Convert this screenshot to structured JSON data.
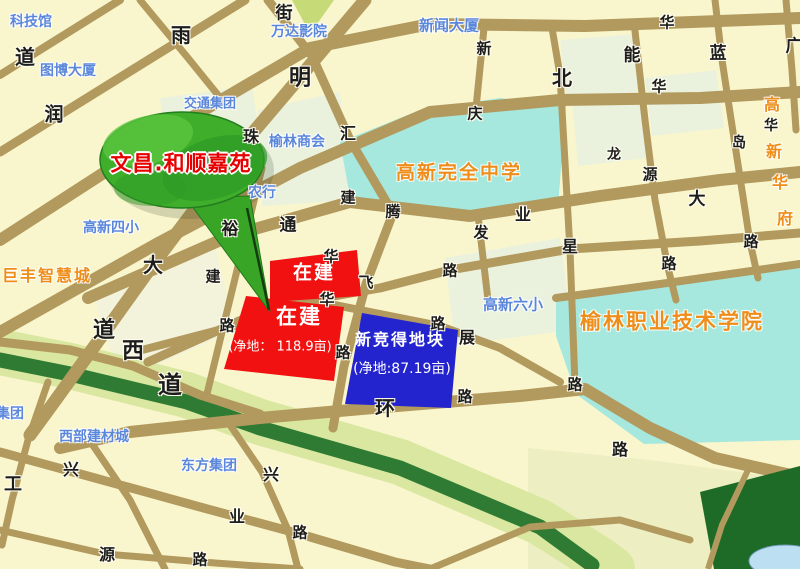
{
  "map": {
    "callout": {
      "label": "文昌.和顺嘉苑"
    },
    "plots": {
      "north_red": {
        "label": "在建"
      },
      "south_red": {
        "label": "在建",
        "area": "(净地： 118.9亩)"
      },
      "new_blue": {
        "label": "新竞得地块",
        "area": "(净地:87.19亩)"
      }
    },
    "colors": {
      "background": "#f9f6cd",
      "road": "#b2995e",
      "water_grounds": "#a6e8de",
      "pond": "#bcdff1",
      "greenbelt_dark": "#2f7b33",
      "greenbelt_light": "#d9e7a0",
      "park_dark": "#1d6b27",
      "parcel_mint": "#eaf2de",
      "plot_red": "#f21111",
      "plot_blue": "#2424cf",
      "callout_green": "#3fae2a",
      "callout_text_red": "#e60000",
      "poi_blue": "#5b87db",
      "poi_orange": "#ee8d1a"
    },
    "labels": [
      {
        "t": "道",
        "x": 25,
        "y": 57,
        "c": "road",
        "s": 20
      },
      {
        "t": "雨",
        "x": 181,
        "y": 35,
        "c": "road",
        "s": 20
      },
      {
        "t": "街",
        "x": 284,
        "y": 14,
        "c": "road",
        "s": 17
      },
      {
        "t": "明",
        "x": 300,
        "y": 79,
        "c": "road",
        "s": 22
      },
      {
        "t": "润",
        "x": 54,
        "y": 115,
        "c": "road",
        "s": 19
      },
      {
        "t": "珠",
        "x": 251,
        "y": 137,
        "c": "road",
        "s": 16
      },
      {
        "t": "汇",
        "x": 348,
        "y": 134,
        "c": "road",
        "s": 16
      },
      {
        "t": "新",
        "x": 484,
        "y": 49,
        "c": "road",
        "s": 15
      },
      {
        "t": "庆",
        "x": 475,
        "y": 114,
        "c": "road",
        "s": 15
      },
      {
        "t": "北",
        "x": 562,
        "y": 78,
        "c": "road",
        "s": 20
      },
      {
        "t": "华",
        "x": 667,
        "y": 23,
        "c": "road",
        "s": 15
      },
      {
        "t": "能",
        "x": 632,
        "y": 56,
        "c": "road",
        "s": 17
      },
      {
        "t": "蓝",
        "x": 718,
        "y": 54,
        "c": "road",
        "s": 17
      },
      {
        "t": "广",
        "x": 794,
        "y": 47,
        "c": "road",
        "s": 17
      },
      {
        "t": "华",
        "x": 659,
        "y": 87,
        "c": "road",
        "s": 15
      },
      {
        "t": "华",
        "x": 771,
        "y": 126,
        "c": "road",
        "s": 14
      },
      {
        "t": "岛",
        "x": 739,
        "y": 143,
        "c": "road",
        "s": 14
      },
      {
        "t": "龙",
        "x": 614,
        "y": 155,
        "c": "road",
        "s": 14
      },
      {
        "t": "源",
        "x": 650,
        "y": 175,
        "c": "road",
        "s": 15
      },
      {
        "t": "大",
        "x": 697,
        "y": 200,
        "c": "road",
        "s": 17
      },
      {
        "t": "路",
        "x": 751,
        "y": 242,
        "c": "road",
        "s": 15
      },
      {
        "t": "路",
        "x": 669,
        "y": 264,
        "c": "road",
        "s": 15
      },
      {
        "t": "裕",
        "x": 230,
        "y": 230,
        "c": "road",
        "s": 17
      },
      {
        "t": "通",
        "x": 288,
        "y": 226,
        "c": "road",
        "s": 17
      },
      {
        "t": "建",
        "x": 348,
        "y": 198,
        "c": "road",
        "s": 15
      },
      {
        "t": "腾",
        "x": 393,
        "y": 212,
        "c": "road",
        "s": 15
      },
      {
        "t": "业",
        "x": 523,
        "y": 215,
        "c": "road",
        "s": 16
      },
      {
        "t": "发",
        "x": 481,
        "y": 233,
        "c": "road",
        "s": 15
      },
      {
        "t": "星",
        "x": 570,
        "y": 247,
        "c": "road",
        "s": 16
      },
      {
        "t": "路",
        "x": 450,
        "y": 271,
        "c": "road",
        "s": 15
      },
      {
        "t": "建",
        "x": 213,
        "y": 277,
        "c": "road",
        "s": 15
      },
      {
        "t": "大",
        "x": 153,
        "y": 265,
        "c": "road",
        "s": 20
      },
      {
        "t": "华",
        "x": 331,
        "y": 257,
        "c": "road",
        "s": 15
      },
      {
        "t": "飞",
        "x": 366,
        "y": 283,
        "c": "road",
        "s": 15
      },
      {
        "t": "华",
        "x": 327,
        "y": 300,
        "c": "road",
        "s": 15
      },
      {
        "t": "路",
        "x": 227,
        "y": 326,
        "c": "road",
        "s": 15
      },
      {
        "t": "道",
        "x": 104,
        "y": 331,
        "c": "road",
        "s": 22
      },
      {
        "t": "西",
        "x": 133,
        "y": 352,
        "c": "road",
        "s": 22
      },
      {
        "t": "道",
        "x": 170,
        "y": 385,
        "c": "road",
        "s": 24
      },
      {
        "t": "路",
        "x": 343,
        "y": 353,
        "c": "road",
        "s": 15
      },
      {
        "t": "路",
        "x": 438,
        "y": 324,
        "c": "road",
        "s": 15
      },
      {
        "t": "展",
        "x": 467,
        "y": 338,
        "c": "road",
        "s": 16
      },
      {
        "t": "路",
        "x": 465,
        "y": 397,
        "c": "road",
        "s": 15
      },
      {
        "t": "环",
        "x": 385,
        "y": 408,
        "c": "road",
        "s": 20
      },
      {
        "t": "路",
        "x": 575,
        "y": 385,
        "c": "road",
        "s": 15
      },
      {
        "t": "路",
        "x": 620,
        "y": 450,
        "c": "road",
        "s": 16
      },
      {
        "t": "工",
        "x": 13,
        "y": 485,
        "c": "road",
        "s": 18
      },
      {
        "t": "兴",
        "x": 71,
        "y": 470,
        "c": "road",
        "s": 16
      },
      {
        "t": "兴",
        "x": 271,
        "y": 475,
        "c": "road",
        "s": 16
      },
      {
        "t": "业",
        "x": 237,
        "y": 517,
        "c": "road",
        "s": 16
      },
      {
        "t": "路",
        "x": 300,
        "y": 533,
        "c": "road",
        "s": 15
      },
      {
        "t": "源",
        "x": 107,
        "y": 555,
        "c": "road",
        "s": 16
      },
      {
        "t": "路",
        "x": 200,
        "y": 560,
        "c": "road",
        "s": 15
      },
      {
        "t": "科技馆",
        "x": 31,
        "y": 22,
        "c": "blue",
        "s": 14,
        "n": "poi-science-museum"
      },
      {
        "t": "图博大厦",
        "x": 68,
        "y": 71,
        "c": "blue",
        "s": 14,
        "n": "poi-tubo-building"
      },
      {
        "t": "交通集团",
        "x": 210,
        "y": 104,
        "c": "blue",
        "s": 13,
        "n": "poi-transport-group"
      },
      {
        "t": "万达影院",
        "x": 299,
        "y": 32,
        "c": "blue",
        "s": 14,
        "n": "poi-wanda-cinema"
      },
      {
        "t": "新闻大厦",
        "x": 449,
        "y": 26,
        "c": "blue",
        "s": 15,
        "n": "poi-news-building"
      },
      {
        "t": "榆林商会",
        "x": 297,
        "y": 142,
        "c": "blue",
        "s": 14,
        "n": "poi-yulin-chamber"
      },
      {
        "t": "农行",
        "x": 262,
        "y": 193,
        "c": "blue",
        "s": 14,
        "n": "poi-agricultural-bank"
      },
      {
        "t": "高新四小",
        "x": 111,
        "y": 228,
        "c": "blue",
        "s": 14,
        "n": "poi-gaoxin-no4-primary"
      },
      {
        "t": "高新六小",
        "x": 513,
        "y": 305,
        "c": "blue",
        "s": 15,
        "n": "poi-gaoxin-no6-primary"
      },
      {
        "t": "西部建材城",
        "x": 94,
        "y": 437,
        "c": "blue",
        "s": 14,
        "n": "poi-western-building-materials"
      },
      {
        "t": "东方集团",
        "x": 209,
        "y": 466,
        "c": "blue",
        "s": 14,
        "n": "poi-dongfang-group"
      },
      {
        "t": "集团",
        "x": 10,
        "y": 414,
        "c": "blue",
        "s": 14,
        "n": "poi-group-partial"
      },
      {
        "t": "高新完全中学",
        "x": 459,
        "y": 173,
        "c": "orange",
        "s": 19,
        "n": "poi-gaoxin-high-school"
      },
      {
        "t": "巨丰智慧城",
        "x": 47,
        "y": 276,
        "c": "orange",
        "s": 16,
        "n": "poi-jufeng-smart-city"
      },
      {
        "t": "榆林职业技术学院",
        "x": 672,
        "y": 322,
        "c": "orange",
        "s": 21,
        "n": "poi-yulin-vocational-college"
      },
      {
        "t": "高",
        "x": 773,
        "y": 105,
        "c": "orange",
        "s": 16,
        "n": "poi-gaoxinhuafu-char"
      },
      {
        "t": "新",
        "x": 775,
        "y": 152,
        "c": "orange",
        "s": 16,
        "n": "poi-gaoxinhuafu-char"
      },
      {
        "t": "华",
        "x": 781,
        "y": 183,
        "c": "orange",
        "s": 16,
        "n": "poi-gaoxinhuafu-char"
      },
      {
        "t": "府",
        "x": 786,
        "y": 219,
        "c": "orange",
        "s": 16,
        "n": "poi-gaoxinhuafu-char"
      },
      {
        "t": "文昌.和顺嘉苑",
        "x": 181,
        "y": 164,
        "c": "callout",
        "s": 21,
        "n": "callout-label"
      },
      {
        "t": "在建",
        "x": 314,
        "y": 273,
        "c": "plot",
        "s": 19,
        "n": "plot-north-label"
      },
      {
        "t": "在建",
        "x": 299,
        "y": 317,
        "c": "plot",
        "s": 21,
        "n": "plot-south-label"
      },
      {
        "t": "(净地： 118.9亩)",
        "x": 280,
        "y": 347,
        "c": "plotsub",
        "s": 13,
        "n": "plot-south-area"
      },
      {
        "t": "新竞得地块",
        "x": 400,
        "y": 340,
        "c": "plot",
        "s": 16,
        "n": "plot-new-label"
      },
      {
        "t": "(净地:87.19亩)",
        "x": 402,
        "y": 369,
        "c": "plotsub",
        "s": 14,
        "n": "plot-new-area"
      }
    ]
  }
}
